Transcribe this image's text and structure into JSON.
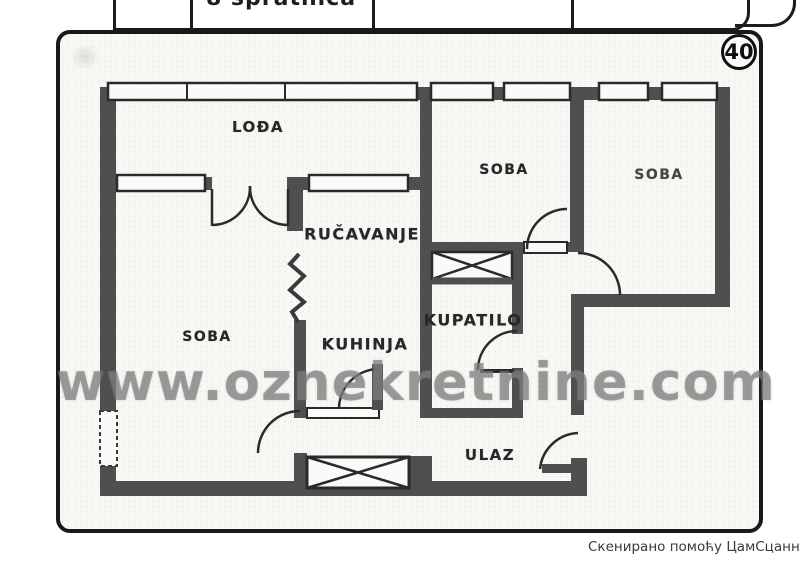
{
  "page": {
    "plan_number": "40",
    "top_strip_fragment": "8 spratnica",
    "watermark": "www.oznekretnine.com",
    "scanner_credit": "Скенирано помоћу ЦамСцаннер-а"
  },
  "rooms": {
    "loggia": {
      "label": "LOĐA"
    },
    "soba_top": {
      "label": "SOBA"
    },
    "soba_right": {
      "label": "SOBA"
    },
    "dining": {
      "label": "RUČAVANJE"
    },
    "soba_left": {
      "label": "SOBA"
    },
    "kitchen": {
      "label": "KUHINJA"
    },
    "bathroom": {
      "label": "KUPATILO"
    },
    "entrance": {
      "label": "ULAZ"
    }
  },
  "colors": {
    "wall": "#4f4f4f",
    "ink": "#2a2a2a",
    "watermark": "#7a7a7a",
    "scan_background": "#f8f7f4"
  }
}
